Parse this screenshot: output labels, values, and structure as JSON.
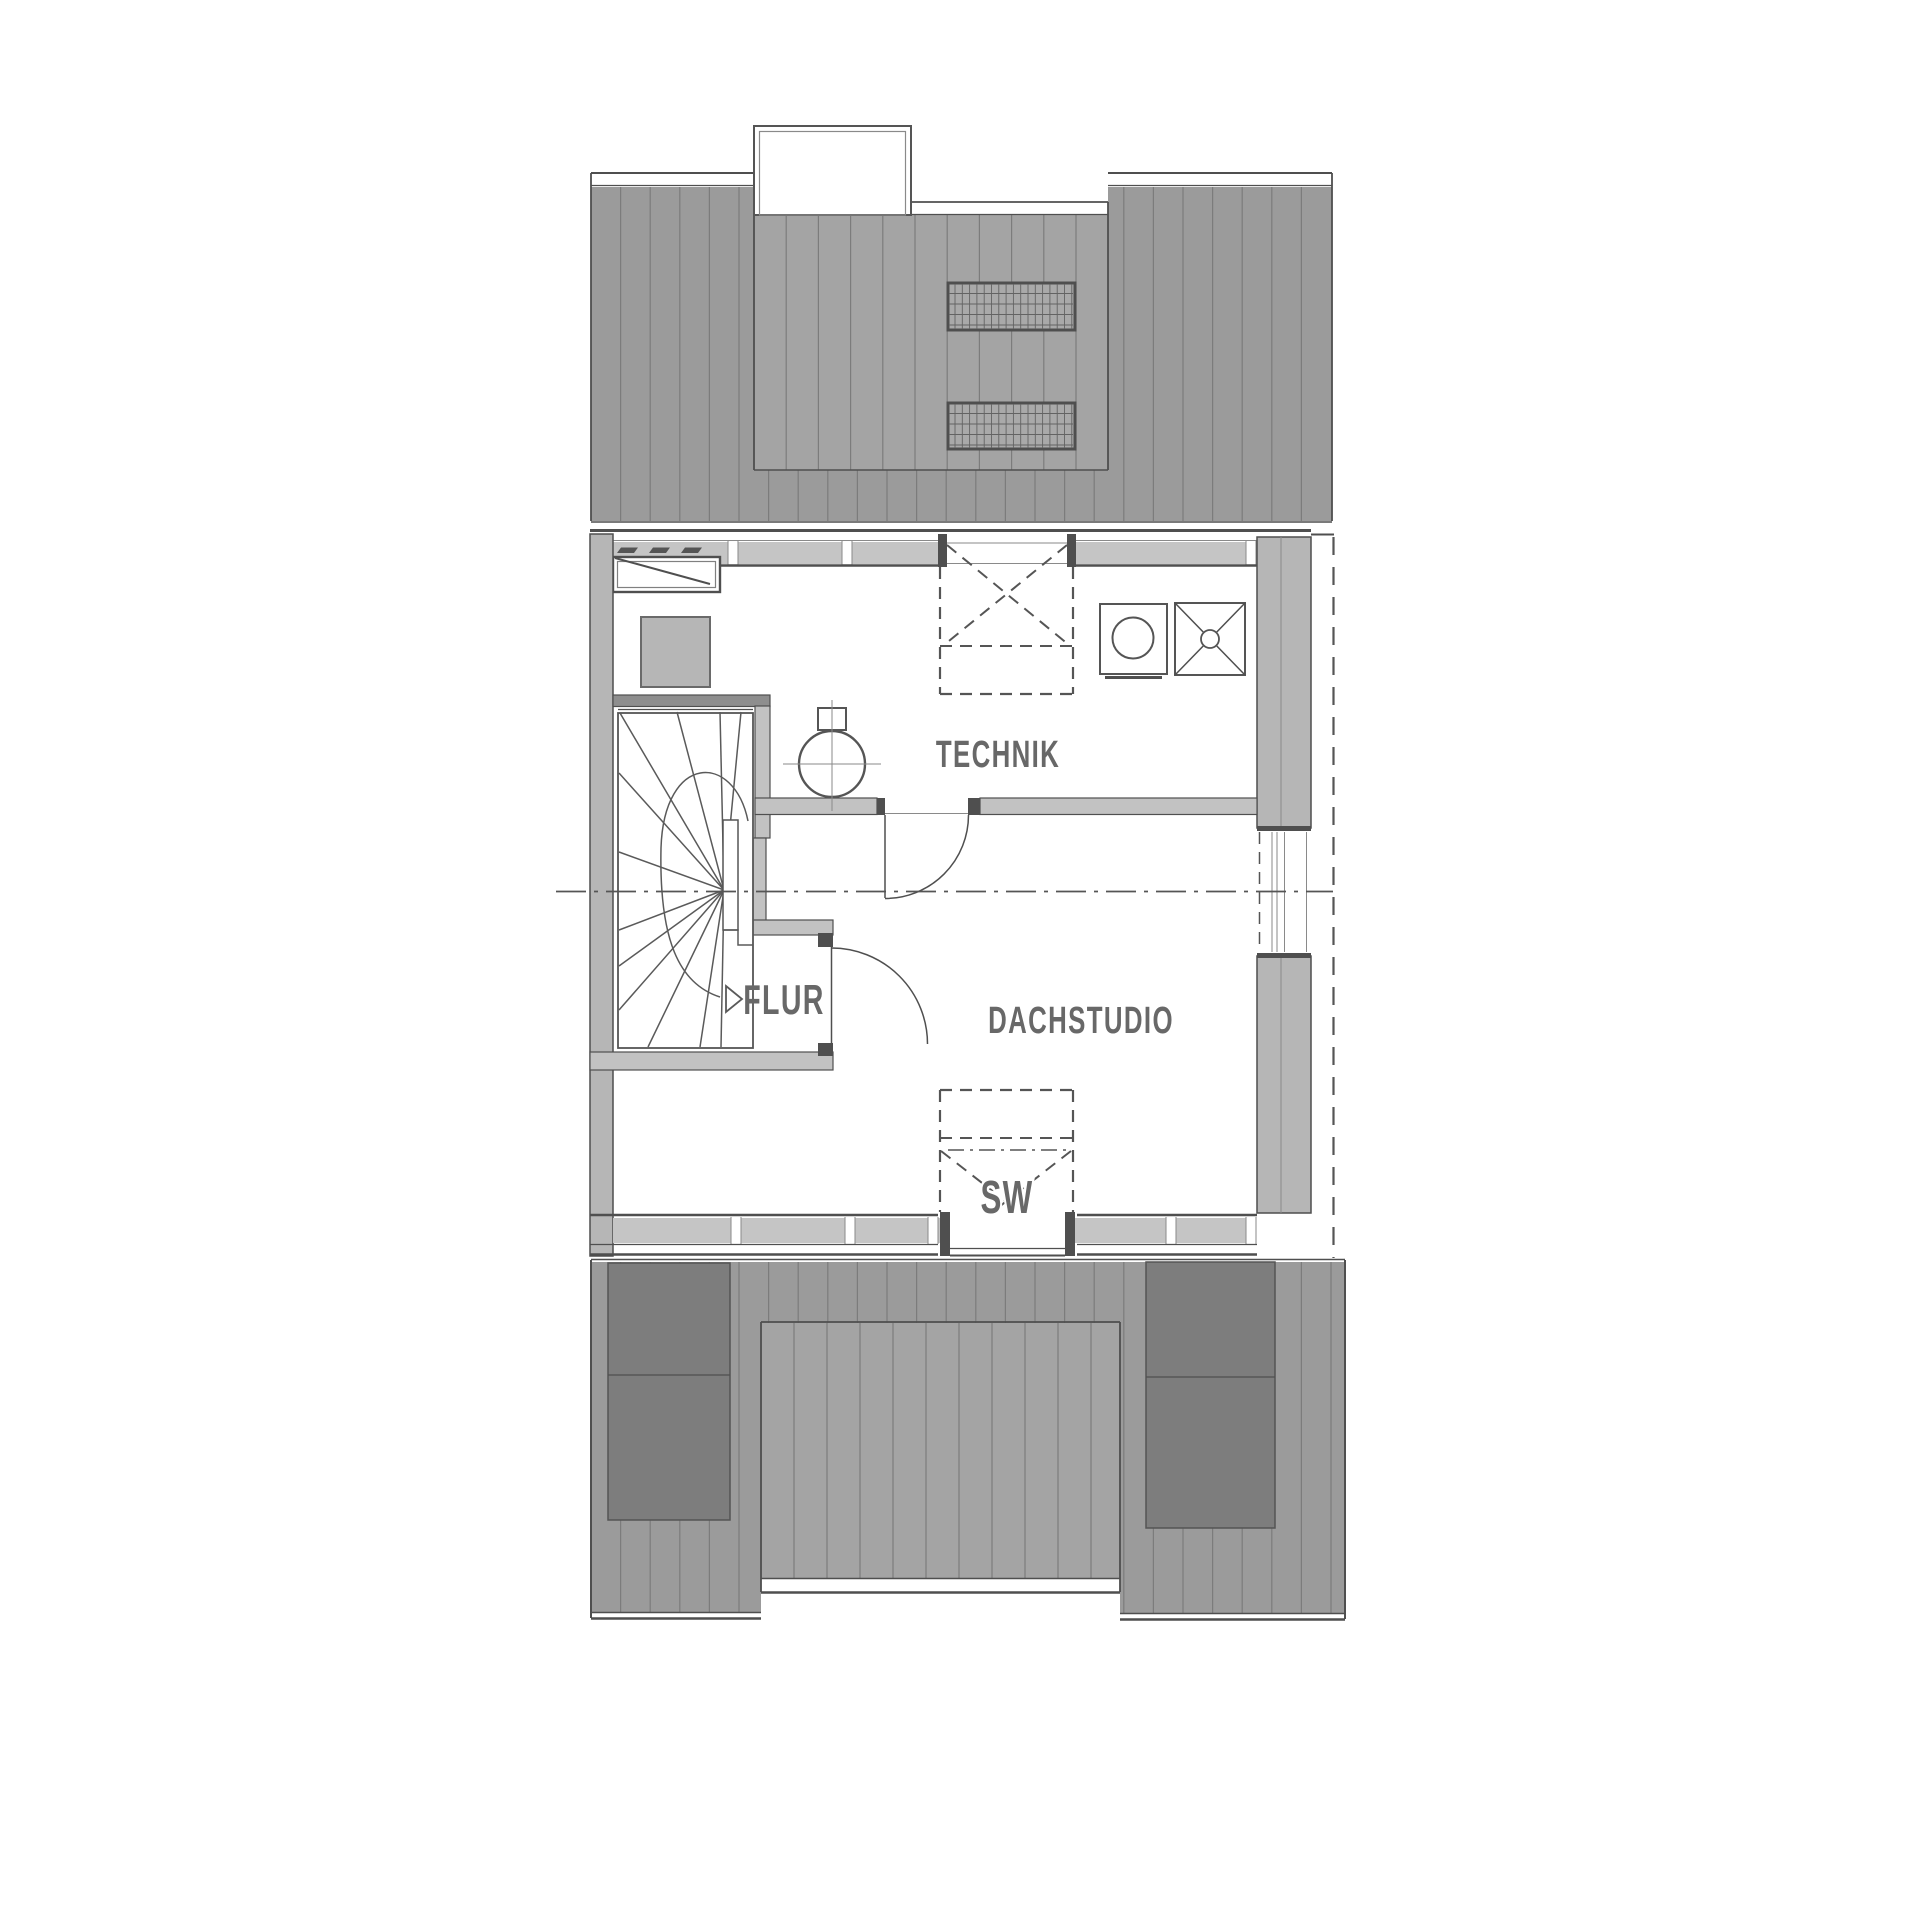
{
  "rooms": {
    "technik": {
      "label": "TECHNIK"
    },
    "flur": {
      "label": "FLUR"
    },
    "dachstudio": {
      "label": "DACHSTUDIO"
    },
    "skylight": {
      "label": "SW"
    }
  },
  "colors": {
    "roof": "#9b9b9b",
    "dormer": "#a4a4a4",
    "seam": "#7c7c7c",
    "panel": "#7d7d7d",
    "wallout": "#b6b6b6",
    "wallint": "#c2c2c2",
    "sill": "#c5c5c5",
    "stairwall": "#8e8e8e",
    "sky": "#a9a9a9",
    "line": "#4f4f4f",
    "text": "#686868"
  }
}
